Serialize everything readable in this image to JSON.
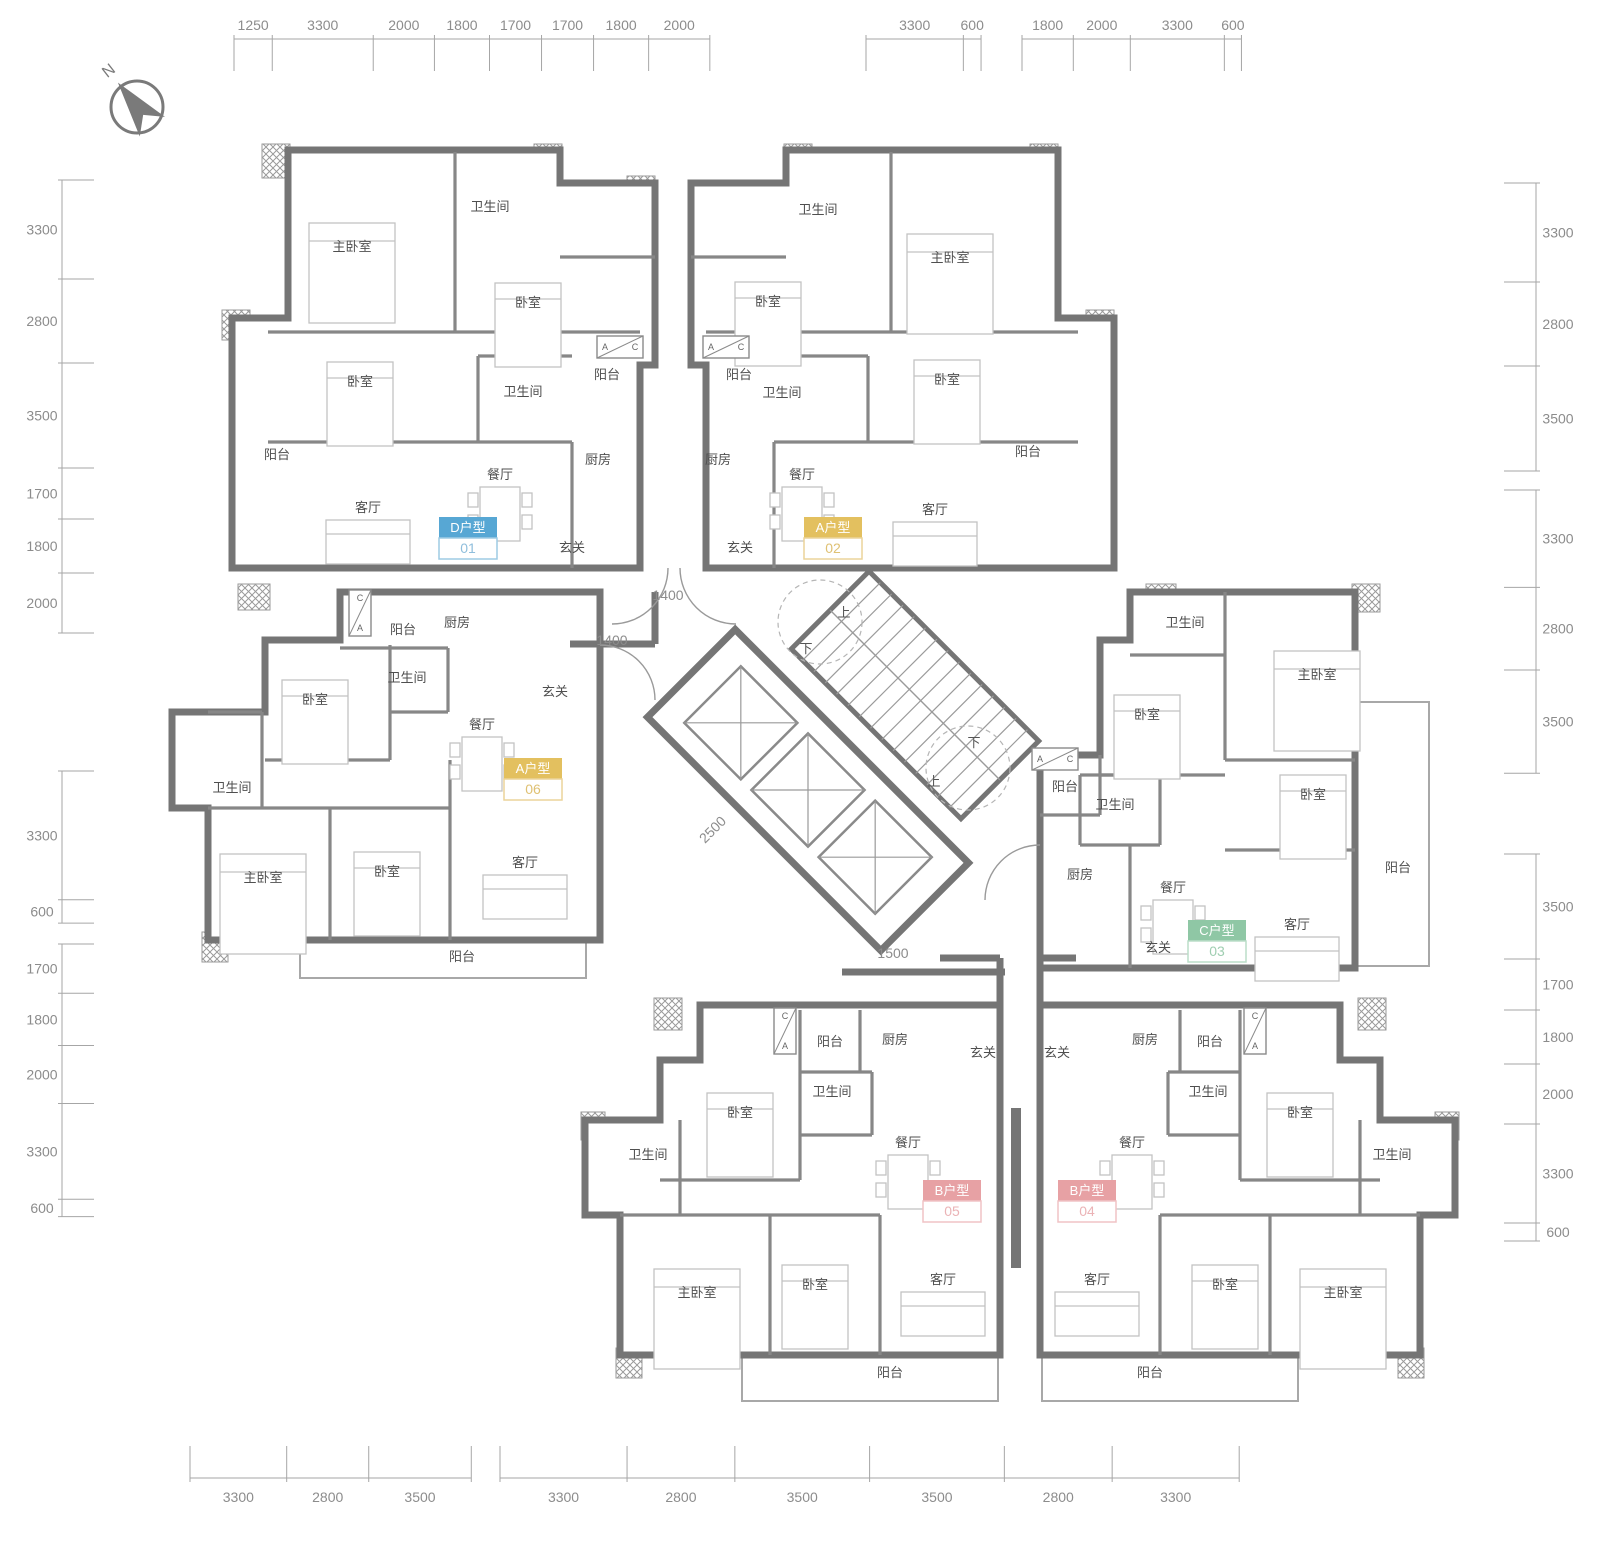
{
  "page": {
    "width": 1600,
    "height": 1549
  },
  "compass": {
    "label": "N"
  },
  "rulers": {
    "top": {
      "line": 39,
      "groups": [
        {
          "start": 234,
          "k": 0.0306,
          "values": [
            1250,
            3300,
            2000,
            1800,
            1700,
            1700,
            1800,
            2000
          ]
        },
        {
          "start": 866,
          "k": 0.0295,
          "values": [
            3300,
            600
          ]
        },
        {
          "start": 1022,
          "k": 0.0285,
          "values": [
            1800,
            2000,
            3300,
            600
          ]
        }
      ]
    },
    "bottom": {
      "line": 1478,
      "groups": [
        {
          "start": 190,
          "k": 0.0293,
          "values": [
            3300,
            2800,
            3500
          ]
        },
        {
          "start": 500,
          "k": 0.0385,
          "values": [
            3300,
            2800,
            3500,
            3500,
            2800,
            3300
          ]
        }
      ]
    },
    "left": {
      "line": 62,
      "groups": [
        {
          "start": 180,
          "k": 0.03,
          "values": [
            3300,
            2800,
            3500,
            1700,
            1800,
            2000
          ]
        },
        {
          "start": 771,
          "k": 0.039,
          "values": [
            3300,
            600
          ]
        },
        {
          "start": 944,
          "k": 0.029,
          "values": [
            1700,
            1800,
            2000,
            3300,
            600
          ]
        }
      ]
    },
    "right": {
      "line": 1536,
      "groups": [
        {
          "start": 183,
          "k": 0.03,
          "values": [
            3300,
            2800,
            3500
          ]
        },
        {
          "start": 490,
          "k": 0.0295,
          "values": [
            3300,
            2800,
            3500
          ]
        },
        {
          "start": 854,
          "k": 0.03,
          "values": [
            3500,
            1700,
            1800,
            2000,
            3300,
            600
          ]
        }
      ]
    }
  },
  "inner_dims": [
    {
      "text": "1400",
      "x": 668,
      "y": 600,
      "rot": 0
    },
    {
      "text": "1400",
      "x": 612,
      "y": 645,
      "rot": 0
    },
    {
      "text": "2500",
      "x": 716,
      "y": 833,
      "rot": -45
    },
    {
      "text": "1500",
      "x": 893,
      "y": 958,
      "rot": 0
    }
  ],
  "core": {
    "stair_labels": [
      {
        "text": "上",
        "x": 844,
        "y": 617
      },
      {
        "text": "下",
        "x": 806,
        "y": 653
      },
      {
        "text": "下",
        "x": 974,
        "y": 747
      },
      {
        "text": "上",
        "x": 934,
        "y": 786
      }
    ]
  },
  "ac_boxes": [
    {
      "x": 597,
      "y": 336,
      "w": 46,
      "h": 22,
      "vert": false,
      "l1": "A",
      "l2": "C"
    },
    {
      "x": 703,
      "y": 336,
      "w": 46,
      "h": 22,
      "vert": false,
      "l1": "A",
      "l2": "C"
    },
    {
      "x": 1032,
      "y": 748,
      "w": 46,
      "h": 22,
      "vert": false,
      "l1": "A",
      "l2": "C"
    },
    {
      "x": 349,
      "y": 590,
      "w": 22,
      "h": 46,
      "vert": true,
      "l1": "C",
      "l2": "A"
    },
    {
      "x": 774,
      "y": 1008,
      "w": 22,
      "h": 46,
      "vert": true,
      "l1": "C",
      "l2": "A"
    },
    {
      "x": 1244,
      "y": 1008,
      "w": 22,
      "h": 46,
      "vert": true,
      "l1": "C",
      "l2": "A"
    }
  ],
  "units": [
    {
      "id": "unit-01",
      "type_label": "D户型",
      "code": "01",
      "color": "#57A7D4",
      "border": "#9ECBE4",
      "num_color": "#8FBEDC",
      "badge": {
        "x": 468,
        "y": 528
      },
      "rooms": [
        {
          "name": "主卧室",
          "x": 352,
          "y": 247
        },
        {
          "name": "卫生间",
          "x": 490,
          "y": 207
        },
        {
          "name": "卧室",
          "x": 528,
          "y": 303
        },
        {
          "name": "卧室",
          "x": 360,
          "y": 382
        },
        {
          "name": "卫生间",
          "x": 523,
          "y": 392
        },
        {
          "name": "餐厅",
          "x": 500,
          "y": 475
        },
        {
          "name": "厨房",
          "x": 598,
          "y": 460
        },
        {
          "name": "阳台",
          "x": 607,
          "y": 375
        },
        {
          "name": "阳台",
          "x": 277,
          "y": 455
        },
        {
          "name": "客厅",
          "x": 368,
          "y": 508
        },
        {
          "name": "玄关",
          "x": 572,
          "y": 548
        }
      ]
    },
    {
      "id": "unit-02",
      "type_label": "A户型",
      "code": "02",
      "color": "#E3C05F",
      "border": "#EBD49A",
      "num_color": "#DFC173",
      "badge": {
        "x": 833,
        "y": 528
      },
      "rooms": [
        {
          "name": "卫生间",
          "x": 818,
          "y": 210
        },
        {
          "name": "主卧室",
          "x": 950,
          "y": 258
        },
        {
          "name": "卧室",
          "x": 768,
          "y": 302
        },
        {
          "name": "卧室",
          "x": 947,
          "y": 380
        },
        {
          "name": "卫生间",
          "x": 782,
          "y": 393
        },
        {
          "name": "餐厅",
          "x": 802,
          "y": 475
        },
        {
          "name": "厨房",
          "x": 718,
          "y": 460
        },
        {
          "name": "阳台",
          "x": 739,
          "y": 375
        },
        {
          "name": "客厅",
          "x": 935,
          "y": 510
        },
        {
          "name": "阳台",
          "x": 1028,
          "y": 452
        },
        {
          "name": "玄关",
          "x": 740,
          "y": 548
        }
      ]
    },
    {
      "id": "unit-06",
      "type_label": "A户型",
      "code": "06",
      "color": "#E3C05F",
      "border": "#EBD49A",
      "num_color": "#DFC173",
      "badge": {
        "x": 533,
        "y": 769
      },
      "rooms": [
        {
          "name": "阳台",
          "x": 403,
          "y": 630
        },
        {
          "name": "厨房",
          "x": 457,
          "y": 623
        },
        {
          "name": "玄关",
          "x": 555,
          "y": 692
        },
        {
          "name": "卫生间",
          "x": 407,
          "y": 678
        },
        {
          "name": "卧室",
          "x": 315,
          "y": 700
        },
        {
          "name": "餐厅",
          "x": 482,
          "y": 725
        },
        {
          "name": "卫生间",
          "x": 232,
          "y": 788
        },
        {
          "name": "主卧室",
          "x": 263,
          "y": 878
        },
        {
          "name": "卧室",
          "x": 387,
          "y": 872
        },
        {
          "name": "客厅",
          "x": 525,
          "y": 863
        },
        {
          "name": "阳台",
          "x": 462,
          "y": 957
        }
      ]
    },
    {
      "id": "unit-03",
      "type_label": "C户型",
      "code": "03",
      "color": "#8FC7A5",
      "border": "#BBDEC9",
      "num_color": "#9FCEB1",
      "badge": {
        "x": 1217,
        "y": 931
      },
      "rooms": [
        {
          "name": "卫生间",
          "x": 1185,
          "y": 623
        },
        {
          "name": "主卧室",
          "x": 1317,
          "y": 675
        },
        {
          "name": "卧室",
          "x": 1147,
          "y": 715
        },
        {
          "name": "阳台",
          "x": 1065,
          "y": 787
        },
        {
          "name": "卫生间",
          "x": 1115,
          "y": 805
        },
        {
          "name": "卧室",
          "x": 1313,
          "y": 795
        },
        {
          "name": "厨房",
          "x": 1080,
          "y": 875
        },
        {
          "name": "餐厅",
          "x": 1173,
          "y": 888
        },
        {
          "name": "客厅",
          "x": 1297,
          "y": 925
        },
        {
          "name": "阳台",
          "x": 1398,
          "y": 868
        },
        {
          "name": "玄关",
          "x": 1158,
          "y": 948
        }
      ]
    },
    {
      "id": "unit-05",
      "type_label": "B户型",
      "code": "05",
      "color": "#E7A1A4",
      "border": "#F0C3C5",
      "num_color": "#EBB3B6",
      "badge": {
        "x": 952,
        "y": 1191
      },
      "rooms": [
        {
          "name": "阳台",
          "x": 830,
          "y": 1042
        },
        {
          "name": "厨房",
          "x": 895,
          "y": 1040
        },
        {
          "name": "玄关",
          "x": 983,
          "y": 1053
        },
        {
          "name": "卫生间",
          "x": 832,
          "y": 1092
        },
        {
          "name": "卧室",
          "x": 740,
          "y": 1113
        },
        {
          "name": "餐厅",
          "x": 908,
          "y": 1143
        },
        {
          "name": "卫生间",
          "x": 648,
          "y": 1155
        },
        {
          "name": "主卧室",
          "x": 697,
          "y": 1293
        },
        {
          "name": "卧室",
          "x": 815,
          "y": 1285
        },
        {
          "name": "客厅",
          "x": 943,
          "y": 1280
        },
        {
          "name": "阳台",
          "x": 890,
          "y": 1373
        }
      ]
    },
    {
      "id": "unit-04",
      "type_label": "B户型",
      "code": "04",
      "color": "#E7A1A4",
      "border": "#F0C3C5",
      "num_color": "#EBB3B6",
      "badge": {
        "x": 1087,
        "y": 1191
      },
      "rooms": [
        {
          "name": "阳台",
          "x": 1210,
          "y": 1042
        },
        {
          "name": "厨房",
          "x": 1145,
          "y": 1040
        },
        {
          "name": "玄关",
          "x": 1057,
          "y": 1053
        },
        {
          "name": "卫生间",
          "x": 1208,
          "y": 1092
        },
        {
          "name": "卧室",
          "x": 1300,
          "y": 1113
        },
        {
          "name": "餐厅",
          "x": 1132,
          "y": 1143
        },
        {
          "name": "卫生间",
          "x": 1392,
          "y": 1155
        },
        {
          "name": "主卧室",
          "x": 1343,
          "y": 1293
        },
        {
          "name": "卧室",
          "x": 1225,
          "y": 1285
        },
        {
          "name": "客厅",
          "x": 1097,
          "y": 1280
        },
        {
          "name": "阳台",
          "x": 1150,
          "y": 1373
        }
      ]
    }
  ],
  "plan": {
    "outlines": [
      "288,150 560,150 560,183 655,183 655,365 640,365 640,568 232,568 232,318 288,318",
      "786,150 1058,150 1058,318 1114,318 1114,568 706,568 706,365 691,365 691,183 786,183",
      "265,640 340,640 340,592 600,592 600,940 208,940 208,808 172,808 172,712 265,712",
      "1130,592 1355,592 1355,968 1040,968 1040,755 1100,755 1100,640 1130,640",
      "700,1005 1000,1005 1000,1355 620,1355 620,1215 585,1215 585,1120 660,1120 660,1060 700,1060",
      "1340,1005 1040,1005 1040,1355 1420,1355 1420,1215 1455,1215 1455,1120 1380,1120 1380,1060 1340,1060"
    ],
    "partitions": [
      [
        268,
        332,
        640,
        332
      ],
      [
        455,
        152,
        455,
        332
      ],
      [
        560,
        257,
        655,
        257
      ],
      [
        268,
        442,
        572,
        442
      ],
      [
        572,
        442,
        572,
        568
      ],
      [
        478,
        356,
        478,
        442
      ],
      [
        478,
        356,
        572,
        356
      ],
      [
        706,
        332,
        1078,
        332
      ],
      [
        891,
        152,
        891,
        332
      ],
      [
        691,
        257,
        786,
        257
      ],
      [
        774,
        442,
        1078,
        442
      ],
      [
        774,
        442,
        774,
        568
      ],
      [
        868,
        356,
        868,
        442
      ],
      [
        774,
        356,
        868,
        356
      ],
      [
        265,
        760,
        390,
        760
      ],
      [
        390,
        645,
        390,
        760
      ],
      [
        340,
        648,
        448,
        648
      ],
      [
        448,
        648,
        448,
        712
      ],
      [
        390,
        712,
        448,
        712
      ],
      [
        262,
        712,
        262,
        808
      ],
      [
        208,
        712,
        262,
        712
      ],
      [
        208,
        808,
        450,
        808
      ],
      [
        330,
        808,
        330,
        940
      ],
      [
        450,
        760,
        450,
        940
      ],
      [
        1130,
        655,
        1225,
        655
      ],
      [
        1225,
        592,
        1225,
        760
      ],
      [
        1225,
        760,
        1355,
        760
      ],
      [
        1100,
        775,
        1225,
        775
      ],
      [
        1225,
        850,
        1355,
        850
      ],
      [
        1080,
        775,
        1160,
        775
      ],
      [
        1160,
        775,
        1160,
        845
      ],
      [
        1080,
        845,
        1160,
        845
      ],
      [
        1080,
        775,
        1080,
        845
      ],
      [
        1130,
        845,
        1130,
        968
      ],
      [
        1040,
        815,
        1100,
        815
      ],
      [
        1100,
        755,
        1100,
        815
      ],
      [
        800,
        1010,
        800,
        1072
      ],
      [
        860,
        1010,
        860,
        1072
      ],
      [
        800,
        1072,
        872,
        1072
      ],
      [
        660,
        1180,
        800,
        1180
      ],
      [
        800,
        1072,
        800,
        1180
      ],
      [
        800,
        1135,
        872,
        1135
      ],
      [
        872,
        1072,
        872,
        1135
      ],
      [
        680,
        1120,
        680,
        1215
      ],
      [
        620,
        1215,
        880,
        1215
      ],
      [
        770,
        1215,
        770,
        1355
      ],
      [
        880,
        1215,
        880,
        1355
      ],
      [
        1240,
        1010,
        1240,
        1072
      ],
      [
        1180,
        1010,
        1180,
        1072
      ],
      [
        1168,
        1072,
        1240,
        1072
      ],
      [
        1240,
        1180,
        1380,
        1180
      ],
      [
        1240,
        1072,
        1240,
        1180
      ],
      [
        1168,
        1135,
        1240,
        1135
      ],
      [
        1168,
        1072,
        1168,
        1135
      ],
      [
        1360,
        1120,
        1360,
        1215
      ],
      [
        1160,
        1215,
        1420,
        1215
      ],
      [
        1270,
        1215,
        1270,
        1355
      ],
      [
        1160,
        1215,
        1160,
        1355
      ]
    ],
    "corridor": [
      [
        655,
        592,
        655,
        644
      ],
      [
        570,
        644,
        655,
        644
      ],
      [
        842,
        972,
        1005,
        972
      ],
      [
        940,
        958,
        1000,
        958
      ],
      [
        1040,
        958,
        1076,
        958
      ],
      [
        1000,
        958,
        1000,
        1005
      ],
      [
        1040,
        958,
        1040,
        1005
      ]
    ],
    "party_wall": [
      1016,
      1108,
      1016,
      1268
    ],
    "balconies": [
      [
        234,
        320,
        32,
        246
      ],
      [
        1080,
        320,
        32,
        246
      ],
      [
        300,
        942,
        286,
        36
      ],
      [
        1357,
        702,
        72,
        264
      ],
      [
        742,
        1357,
        256,
        44
      ],
      [
        1042,
        1357,
        256,
        44
      ]
    ],
    "hatches": [
      [
        262,
        144,
        28,
        34
      ],
      [
        534,
        144,
        28,
        34
      ],
      [
        627,
        176,
        28,
        32
      ],
      [
        784,
        144,
        28,
        34
      ],
      [
        1030,
        144,
        28,
        34
      ],
      [
        222,
        310,
        28,
        30
      ],
      [
        1086,
        310,
        28,
        30
      ],
      [
        238,
        584,
        32,
        26
      ],
      [
        1146,
        584,
        30,
        28
      ],
      [
        1352,
        584,
        28,
        28
      ],
      [
        654,
        998,
        28,
        32
      ],
      [
        1358,
        998,
        28,
        32
      ],
      [
        581,
        1112,
        24,
        28
      ],
      [
        1435,
        1112,
        24,
        28
      ],
      [
        202,
        932,
        26,
        30
      ],
      [
        616,
        1348,
        26,
        30
      ],
      [
        1398,
        1348,
        26,
        30
      ]
    ],
    "doors": [
      "M668,568 A56 56 0 0 1 612,624",
      "M680,568 A56 56 0 0 0 736,624",
      "M1040,845 A55 55 0 0 0 985,900",
      "M600,645 A55 55 0 0 1 655,700"
    ],
    "dash_circles": [
      [
        820,
        622,
        42
      ],
      [
        968,
        768,
        42
      ]
    ]
  }
}
